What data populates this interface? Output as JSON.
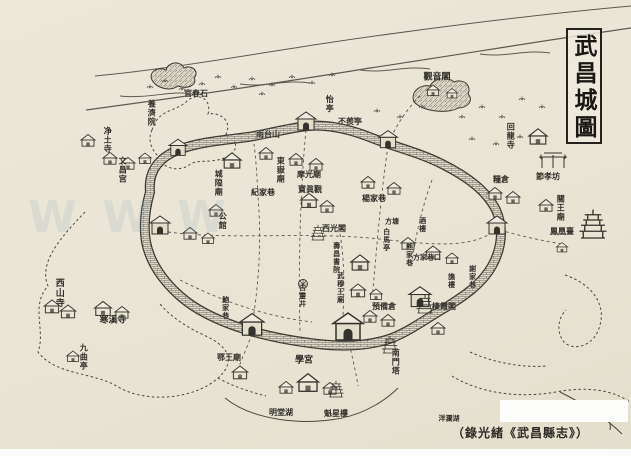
{
  "title": {
    "text": "武昌城圖"
  },
  "caption": {
    "text": "（錄光緒《武昌縣志》）"
  },
  "watermark": {
    "text": "WWW"
  },
  "colors": {
    "paper": "#e9e4d4",
    "ink": "#3b3a33",
    "water": "#6b685c",
    "watermark": "#8ca5b9"
  },
  "map_labels": [
    {
      "text": "官春石",
      "x": 196,
      "y": 93,
      "o": "h",
      "fs": 8
    },
    {
      "text": "養濟院",
      "x": 152,
      "y": 113,
      "o": "v",
      "fs": 8
    },
    {
      "text": "净土寺",
      "x": 108,
      "y": 140,
      "o": "v",
      "fs": 8
    },
    {
      "text": "文昌宫",
      "x": 123,
      "y": 170,
      "o": "v",
      "fs": 8
    },
    {
      "text": "雨台山",
      "x": 268,
      "y": 134,
      "o": "h",
      "fs": 8
    },
    {
      "text": "怡亭",
      "x": 330,
      "y": 104,
      "o": "v",
      "fs": 8
    },
    {
      "text": "不羨亭",
      "x": 350,
      "y": 121,
      "o": "h",
      "fs": 8
    },
    {
      "text": "觀音閣",
      "x": 437,
      "y": 78,
      "o": "h",
      "fs": 9
    },
    {
      "text": "回龍寺",
      "x": 511,
      "y": 136,
      "o": "v",
      "fs": 8
    },
    {
      "text": "糧倉",
      "x": 501,
      "y": 179,
      "o": "h",
      "fs": 8
    },
    {
      "text": "節孝坊",
      "x": 548,
      "y": 176,
      "o": "h",
      "fs": 8
    },
    {
      "text": "關王廟",
      "x": 561,
      "y": 208,
      "o": "v",
      "fs": 8
    },
    {
      "text": "鳳凰臺",
      "x": 562,
      "y": 231,
      "o": "h",
      "fs": 8
    },
    {
      "text": "西山寺",
      "x": 58,
      "y": 293,
      "o": "v",
      "fs": 9
    },
    {
      "text": "寒溪寺",
      "x": 113,
      "y": 321,
      "o": "h",
      "fs": 9
    },
    {
      "text": "九曲亭",
      "x": 84,
      "y": 357,
      "o": "v",
      "fs": 8
    },
    {
      "text": "東嶽廟",
      "x": 281,
      "y": 170,
      "o": "v",
      "fs": 8
    },
    {
      "text": "摩光廟",
      "x": 309,
      "y": 174,
      "o": "h",
      "fs": 8
    },
    {
      "text": "城隍廟",
      "x": 219,
      "y": 183,
      "o": "v",
      "fs": 8
    },
    {
      "text": "紀家巷",
      "x": 263,
      "y": 192,
      "o": "h",
      "fs": 8
    },
    {
      "text": "公館",
      "x": 223,
      "y": 221,
      "o": "v",
      "fs": 8
    },
    {
      "text": "寶眞觀",
      "x": 310,
      "y": 189,
      "o": "h",
      "fs": 8
    },
    {
      "text": "楊家巷",
      "x": 374,
      "y": 198,
      "o": "h",
      "fs": 8
    },
    {
      "text": "西光閣",
      "x": 334,
      "y": 228,
      "o": "h",
      "fs": 8
    },
    {
      "text": "方塘",
      "x": 392,
      "y": 221,
      "o": "h",
      "fs": 7
    },
    {
      "text": "酒樓",
      "x": 423,
      "y": 225,
      "o": "v",
      "fs": 7
    },
    {
      "text": "白馬亭",
      "x": 387,
      "y": 240,
      "o": "v",
      "fs": 7
    },
    {
      "text": "熊家巷",
      "x": 410,
      "y": 255,
      "o": "v",
      "fs": 7
    },
    {
      "text": "方家巷口",
      "x": 427,
      "y": 257,
      "o": "h",
      "fs": 7
    },
    {
      "text": "謝家巷",
      "x": 473,
      "y": 277,
      "o": "v",
      "fs": 7
    },
    {
      "text": "譙樓",
      "x": 452,
      "y": 281,
      "o": "v",
      "fs": 7
    },
    {
      "text": "壽昌書院",
      "x": 337,
      "y": 258,
      "o": "v",
      "fs": 7
    },
    {
      "text": "武穆王廟",
      "x": 341,
      "y": 288,
      "o": "v",
      "fs": 7
    },
    {
      "text": "古靈井",
      "x": 303,
      "y": 296,
      "o": "v",
      "fs": 7
    },
    {
      "text": "預備倉",
      "x": 384,
      "y": 306,
      "o": "h",
      "fs": 8
    },
    {
      "text": "棲霞閣",
      "x": 444,
      "y": 306,
      "o": "h",
      "fs": 8
    },
    {
      "text": "鮑家巷",
      "x": 226,
      "y": 308,
      "o": "v",
      "fs": 7
    },
    {
      "text": "學宮",
      "x": 304,
      "y": 361,
      "o": "h",
      "fs": 9
    },
    {
      "text": "鄂王廟",
      "x": 229,
      "y": 357,
      "o": "h",
      "fs": 8
    },
    {
      "text": "明堂湖",
      "x": 281,
      "y": 412,
      "o": "h",
      "fs": 8
    },
    {
      "text": "魁星樓",
      "x": 336,
      "y": 413,
      "o": "h",
      "fs": 8
    },
    {
      "text": "南門塔",
      "x": 396,
      "y": 362,
      "o": "v",
      "fs": 8
    },
    {
      "text": "洋瀾湖",
      "x": 449,
      "y": 418,
      "o": "h",
      "fs": 7
    }
  ]
}
